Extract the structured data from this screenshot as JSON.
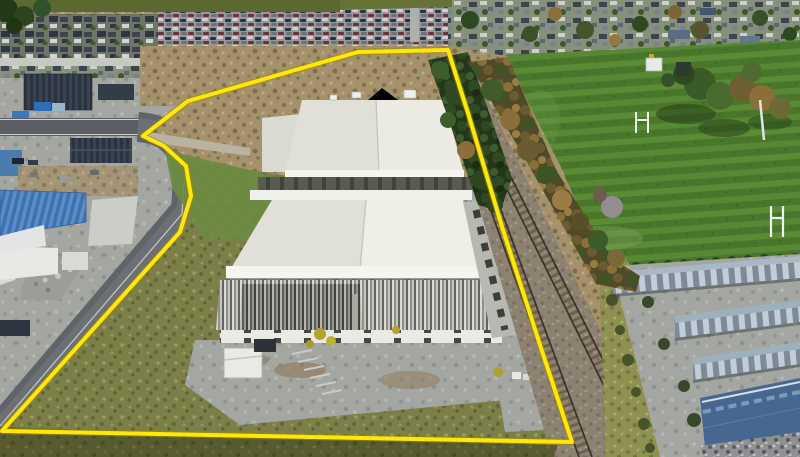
{
  "scene": {
    "type": "aerial-drone-photograph",
    "subject": "industrial property outlined with yellow boundary beside railway line",
    "features": [
      "residential-suburb",
      "car-yard",
      "left-industrial-precinct",
      "access-road",
      "vacant-scrub-land",
      "rear-warehouse",
      "front-warehouse",
      "small-shed",
      "concrete-apron",
      "railway-line",
      "tree-belt",
      "sports-field",
      "rugby-goalposts",
      "storage-units",
      "grass-embankment"
    ]
  },
  "boundary": {
    "stroke_color": "#ffe70a",
    "casing_color": "#a08a00",
    "stroke_width": 4,
    "points": "448,50 468,113 503,230 540,345 572,442 2,431 180,232 191,196 186,166 164,146 143,136 188,101 358,52"
  },
  "palette": {
    "dirt": "#a5916b",
    "field_green": "#4e7c2e",
    "rough_grass": "#7d7f49",
    "rough_dark": "#575b2f",
    "concrete": "#a4a6a2",
    "warehouse_white": "#ebebe4",
    "warehouse_shade": "#e0e0d8",
    "warehouse_bright": "#f0efe5",
    "fascia_white": "#f5f5ef",
    "asphalt": "#5f6266",
    "navy_roof": "#2d3642",
    "blue_roof": "#3d71b0",
    "steel_blue_roof": "#466890",
    "storage_slate": "#9fb0bd",
    "ballast": "#8d8272",
    "rail_dark": "#3a332c",
    "sleeper": "#6f604c",
    "tree_dark": "#2f4a22",
    "tree_autumn": "#8a6f3a",
    "shed_white": "#e8eae3",
    "goalpost_white": "#eef2f0",
    "shadow": "#565650"
  }
}
